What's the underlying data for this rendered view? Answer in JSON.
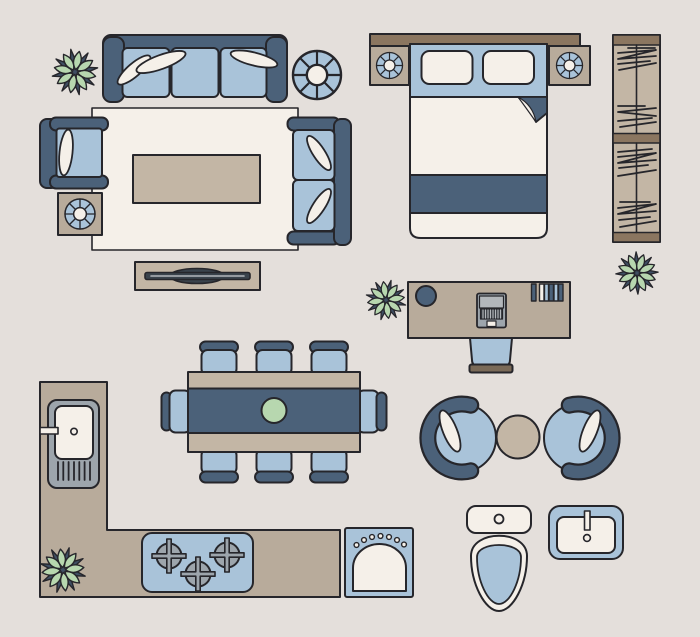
{
  "scene": {
    "type": "floor-plan-furniture-illustration",
    "background": "#e4dfdb"
  },
  "colors": {
    "bg": "#e4dfdb",
    "ink": "#26262b",
    "navy": "#4b6179",
    "blue": "#a9c3d9",
    "cream": "#f5f0e9",
    "tan": "#c3b6a5",
    "taupe": "#b8ab9b",
    "brown": "#8b7660",
    "browndark": "#7a6a58",
    "gray": "#9da5ac",
    "graylight": "#b3b7bb",
    "slate": "#3a434c",
    "keyboard": "#33383e",
    "green": "#b7d7af",
    "star": "#3f4e63"
  },
  "furniture_icons": [
    "potted-plant",
    "three-seat-sofa",
    "throw-pillow",
    "round-side-table",
    "area-rug",
    "armchair",
    "accent-table",
    "coffee-table",
    "loveseat",
    "tv-console",
    "double-bed",
    "headboard",
    "nightstand",
    "bed-pillow",
    "folded-sheet",
    "blanket",
    "wardrobe",
    "hanging-clothes",
    "office-desk",
    "desk-lamp-base",
    "laptop",
    "desk-books",
    "desk-chair",
    "dining-table",
    "table-runner",
    "centerpiece-bowl",
    "dining-chair",
    "kitchen-counter",
    "kitchen-sink",
    "faucet",
    "drainboard",
    "gas-stove",
    "burner",
    "washing-machine",
    "swivel-chair",
    "round-coffee-table",
    "toilet",
    "bathroom-sink"
  ]
}
